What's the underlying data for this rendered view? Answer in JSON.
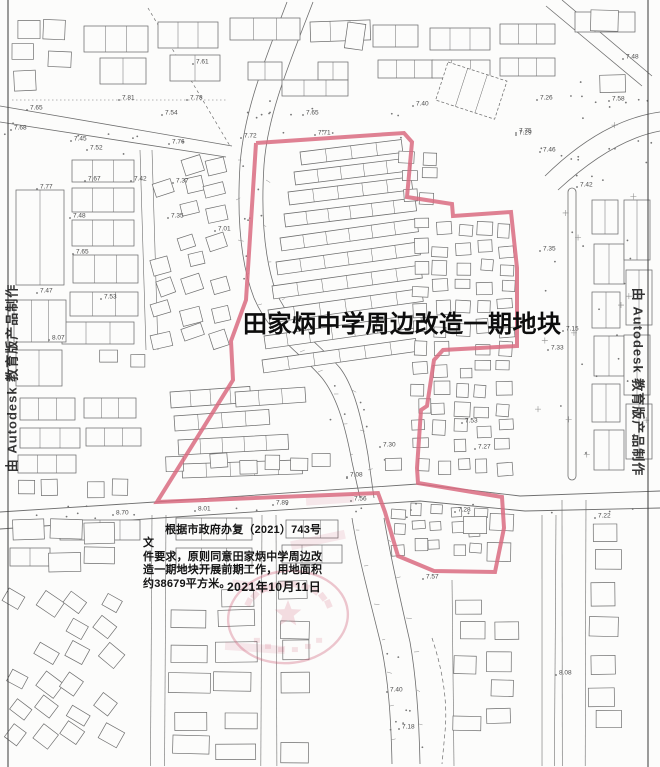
{
  "page": {
    "background": "#fcfcfb",
    "border_color": "#3a3a3a"
  },
  "title": {
    "text": "田家炳中学周边改造一期地块",
    "color": "#0d0d0d"
  },
  "annotation": {
    "lines": [
      "根据市政府办复（2021）743号文",
      "件要求，原则同意田家炳中学周边改",
      "造一期地块开展前期工作，用地面积",
      "约38679平方米。"
    ],
    "date": "2021年10月11日"
  },
  "watermark": {
    "text": "由 Autodesk 教育版产品制作"
  },
  "map": {
    "line_color": "#6e6e6e",
    "boundary": {
      "color": "#d96b80",
      "width": 4,
      "points": [
        [
          256,
          143
        ],
        [
          404,
          133
        ],
        [
          412,
          142
        ],
        [
          407,
          197
        ],
        [
          452,
          204
        ],
        [
          453,
          216
        ],
        [
          511,
          212
        ],
        [
          517,
          268
        ],
        [
          517,
          346
        ],
        [
          443,
          350
        ],
        [
          434,
          360
        ],
        [
          427,
          406
        ],
        [
          421,
          410
        ],
        [
          417,
          468
        ],
        [
          418,
          483
        ],
        [
          502,
          497
        ],
        [
          504,
          528
        ],
        [
          495,
          572
        ],
        [
          434,
          571
        ],
        [
          398,
          556
        ],
        [
          385,
          512
        ],
        [
          378,
          493
        ],
        [
          157,
          502
        ],
        [
          233,
          380
        ],
        [
          231,
          341
        ],
        [
          246,
          300
        ],
        [
          256,
          143
        ]
      ]
    },
    "seal": {
      "name": "official-seal-stamp",
      "color": "#cc5570"
    },
    "elevation_labels": [
      {
        "t": "7.61",
        "x": 196,
        "y": 62
      },
      {
        "t": "7.65",
        "x": 30,
        "y": 108
      },
      {
        "t": "7.81",
        "x": 122,
        "y": 98
      },
      {
        "t": "7.54",
        "x": 165,
        "y": 113
      },
      {
        "t": "7.78",
        "x": 190,
        "y": 98
      },
      {
        "t": "7.68",
        "x": 14,
        "y": 128
      },
      {
        "t": "7.45",
        "x": 74,
        "y": 139
      },
      {
        "t": "7.52",
        "x": 90,
        "y": 148
      },
      {
        "t": "7.76",
        "x": 172,
        "y": 142
      },
      {
        "t": "7.72",
        "x": 244,
        "y": 136
      },
      {
        "t": "7.71",
        "x": 318,
        "y": 133
      },
      {
        "t": "7.65",
        "x": 306,
        "y": 113
      },
      {
        "t": "7.40",
        "x": 416,
        "y": 104
      },
      {
        "t": "7.48",
        "x": 626,
        "y": 57
      },
      {
        "t": "7.26",
        "x": 540,
        "y": 98
      },
      {
        "t": "7.58",
        "x": 612,
        "y": 99
      },
      {
        "t": "7.75",
        "x": 519,
        "y": 131
      },
      {
        "t": "7.46",
        "x": 543,
        "y": 150
      },
      {
        "t": "7.29",
        "x": 519,
        "y": 133
      },
      {
        "t": "7.42",
        "x": 580,
        "y": 185
      },
      {
        "t": "7.35",
        "x": 543,
        "y": 249
      },
      {
        "t": "7.15",
        "x": 566,
        "y": 329
      },
      {
        "t": "7.33",
        "x": 551,
        "y": 348
      },
      {
        "t": "7.77",
        "x": 40,
        "y": 187
      },
      {
        "t": "7.67",
        "x": 88,
        "y": 179
      },
      {
        "t": "7.42",
        "x": 134,
        "y": 179
      },
      {
        "t": "7.37",
        "x": 176,
        "y": 181
      },
      {
        "t": "7.48",
        "x": 73,
        "y": 216
      },
      {
        "t": "7.35",
        "x": 171,
        "y": 216
      },
      {
        "t": "7.65",
        "x": 76,
        "y": 252
      },
      {
        "t": "7.01",
        "x": 218,
        "y": 229
      },
      {
        "t": "7.47",
        "x": 40,
        "y": 291
      },
      {
        "t": "7.53",
        "x": 104,
        "y": 297
      },
      {
        "t": "8.07",
        "x": 52,
        "y": 338
      },
      {
        "t": "7.53",
        "x": 465,
        "y": 421
      },
      {
        "t": "7.30",
        "x": 383,
        "y": 445
      },
      {
        "t": "7.27",
        "x": 478,
        "y": 447
      },
      {
        "t": "7.08",
        "x": 350,
        "y": 475
      },
      {
        "t": "7.56",
        "x": 354,
        "y": 499
      },
      {
        "t": "7.89",
        "x": 276,
        "y": 503
      },
      {
        "t": "8.01",
        "x": 198,
        "y": 509
      },
      {
        "t": "8.70",
        "x": 116,
        "y": 513
      },
      {
        "t": "7.28",
        "x": 458,
        "y": 510
      },
      {
        "t": "7.22",
        "x": 598,
        "y": 516
      },
      {
        "t": "7.57",
        "x": 426,
        "y": 577
      },
      {
        "t": "7.40",
        "x": 390,
        "y": 690
      },
      {
        "t": "7.18",
        "x": 402,
        "y": 727
      },
      {
        "t": "8.08",
        "x": 559,
        "y": 673
      }
    ]
  }
}
